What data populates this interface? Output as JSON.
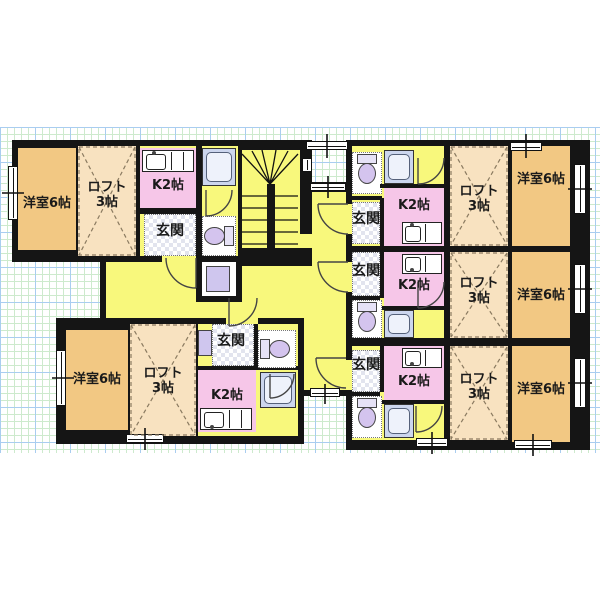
{
  "document_type": "apartment-floor-plan",
  "units": [
    {
      "id": "unit-a",
      "position": "top-left",
      "room_label": "洋室6帖",
      "loft_label": "ロフト\n3帖",
      "kitchen_label": "K2帖",
      "entrance_label": "玄関",
      "fixtures": [
        "toilet",
        "bath",
        "washing-machine",
        "kitchen-sink"
      ]
    },
    {
      "id": "unit-b",
      "position": "bottom-left",
      "room_label": "洋室6帖",
      "loft_label": "ロフト\n3帖",
      "kitchen_label": "K2帖",
      "entrance_label": "玄関",
      "fixtures": [
        "toilet",
        "bath",
        "washing-machine",
        "kitchen-sink"
      ]
    },
    {
      "id": "unit-r1",
      "position": "right-top",
      "room_label": "洋室6帖",
      "loft_label": "ロフト\n3帖",
      "kitchen_label": "K2帖",
      "entrance_label": "玄関",
      "fixtures": [
        "toilet",
        "bath",
        "kitchen-sink"
      ]
    },
    {
      "id": "unit-r2",
      "position": "right-middle",
      "room_label": "洋室6帖",
      "loft_label": "ロフト\n3帖",
      "kitchen_label": "K2帖",
      "entrance_label": "玄関",
      "fixtures": [
        "toilet",
        "bath",
        "kitchen-sink"
      ]
    },
    {
      "id": "unit-r3",
      "position": "right-bottom",
      "room_label": "洋室6帖",
      "loft_label": "ロフト\n3帖",
      "kitchen_label": "K2帖",
      "entrance_label": "玄関",
      "fixtures": [
        "toilet",
        "bath",
        "kitchen-sink"
      ]
    }
  ],
  "common_areas": {
    "staircase": true,
    "corridor": true,
    "lofts_marked_with": "dashed-x"
  },
  "icons": {
    "toilet": "toilet-icon",
    "bath": "bathtub-icon",
    "kitchen_sink": "sink-icon",
    "washing_machine": "washer-icon",
    "door": "door-arc",
    "window": "window-pane",
    "stairs": "staircase-treads",
    "entrance_floor": "checker-tile"
  },
  "colors": {
    "room": "#f2c883",
    "loft": "#f8e2c0",
    "kitchen": "#f6c6e8",
    "hall": "#f8f87c",
    "wall": "#151515",
    "bath": "#ccd6ee",
    "toilet": "#d4c4ee",
    "washer": "#cfc6ee",
    "tile_dark": "#e2e4ee",
    "grid_minor": "#cdeacd",
    "grid_major": "#a9cdf0",
    "line": "#333333"
  }
}
